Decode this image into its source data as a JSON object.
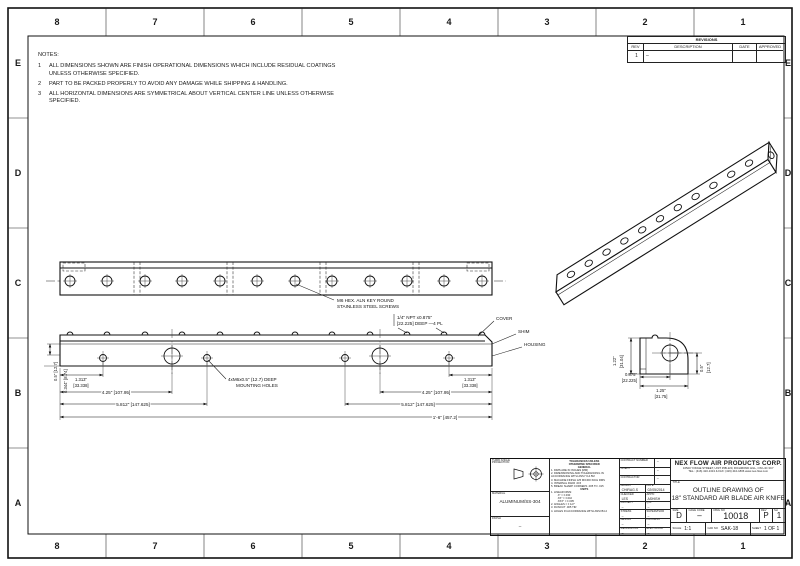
{
  "sheet": {
    "zones_h": [
      "8",
      "7",
      "6",
      "5",
      "4",
      "3",
      "2",
      "1"
    ],
    "zones_v": [
      "E",
      "D",
      "C",
      "B",
      "A"
    ]
  },
  "notes": {
    "title": "NOTES:",
    "items": [
      {
        "num": "1",
        "text": "ALL DIMENSIONS SHOWN ARE FINISH OPERATIONAL DIMENSIONS WHICH INCLUDE RESIDUAL COATINGS UNLESS OTHERWISE SPECIFIED."
      },
      {
        "num": "2",
        "text": "PART TO BE PACKED PROPERLY TO AVOID ANY DAMAGE WHILE SHIPPING & HANDLING."
      },
      {
        "num": "3",
        "text": "ALL HORIZONTAL DIMENSIONS ARE SYMMETRICAL ABOUT VERTICAL CENTER LINE UNLESS OTHERWISE SPECIFIED."
      }
    ]
  },
  "revisions": {
    "title": "REVISIONS",
    "headers": [
      "REV",
      "DESCRIPTION",
      "DATE",
      "APPROVED"
    ],
    "row": {
      "rev": "1",
      "description": "–",
      "date": "",
      "approved": ""
    }
  },
  "callouts": {
    "screws_l1": "M6 HEX. ALN KEY ROUND",
    "screws_l2": "STAINLESS STEEL SCREWS",
    "npt_l1": "1/4\" NPT x0.875\"",
    "npt_l2": "[22.225] DEEP —4 PL",
    "mount_l1": "4xM6x0.5\" (12.7) DEEP",
    "mount_l2": "MOUNTING HOLES",
    "cover": "COVER",
    "shim": "SHIM",
    "housing": "HOUSING"
  },
  "dims": {
    "front": {
      "d1_l1": "1.313\"",
      "d1_l2": "[33.338]",
      "d2": "4.25\" [107.95]",
      "d3": "5.812\" [147.625]",
      "overall": "1'-6\" [457.2]",
      "v1": "0.5\" [12.7]",
      "v2": "0.344\" [8.74]"
    },
    "side": {
      "h_l1": "1.22\"",
      "h_l2": "[31.04]",
      "b_l1": "0.875\"",
      "b_l2": "[22.225]",
      "w_l1": "1.25\"",
      "w_l2": "[31.75]",
      "r_l1": "0.5\"",
      "r_l2": "[12.7]"
    }
  },
  "titleblock": {
    "company": "NEX FLOW AIR PRODUCTS CORP.",
    "address1": "10520 YONGE STREET, UNIT 35B-220, RICHMOND HILL, ON L4C 3C7",
    "address2": "TEL.: (416) 410-1313 & FAX: (416) 410-1806  www.nex-flow.com",
    "title_label": "TITLE",
    "title_line1": "OUTLINE DRAWING OF",
    "title_line2": "18\" STANDARD AIR BLADE AIR KNIFE",
    "projection_label": "THIRD ANGLE PROJECTION",
    "material_label": "MATERIAL",
    "material_value": "ALUMINUM/SS-304",
    "finish_label": "FINISH",
    "finish_value": "–",
    "tolerances": {
      "header1": "TOLERANCES UNLESS",
      "header2": "OTHERWISE SPECIFIED",
      "general_title": "GENERAL",
      "general_items": [
        "1. DIMS ARE IN INCHES [MM]",
        "2. DIMENSIONING AND TOLERANCING IN ACCORDANCE WITH ANSI Y14.5M",
        "3. MACHINE FINISH 125 MICRO INCH RMS",
        "4. INTERNAL RADII .015",
        "5. BREAK SHARP CORNERS .005 TO .015"
      ],
      "units_title": "UNITS",
      "units_items": [
        "1. LINEAR DIMS:",
        ".X\" = ±.030",
        ".XX\" = ±.010",
        ".XXX\" = ±.005",
        "2. ANGLES = ± 1/2°",
        "3. RUNOUT .005 TIR",
        "4. HOLES IN ACCORDANCE WITH ANSI B4.2"
      ]
    },
    "fields": {
      "contract_label": "CONTRACT NUMBER",
      "contract_value": "–",
      "client_label": "CLIENT",
      "client_value": "–",
      "contractor_label": "CONTRACTOR",
      "contractor_value": "–",
      "drawn_label": "DRAWN",
      "drawn_value": "CHIRAG.S",
      "date_label": "DATE",
      "date_value": "02/05/2014",
      "checked_label": "CHECKED",
      "checked_value": "LES",
      "approved_label": "APP'D",
      "approved_value": "ASHISH",
      "project_label": "PROJECT",
      "project_value": "–",
      "qa_label": "Q.A.",
      "qa_value": "–",
      "stress_label": "STRESS",
      "stress_value": "–",
      "supervisor_label": "SUPERVISOR",
      "supervisor_value": "–",
      "design_label": "DESIGN",
      "design_value": "–",
      "process_label": "PROCESS",
      "process_value": "–",
      "mechanical_label": "MECHANICAL",
      "mechanical_value": "–",
      "electrical_label": "ELECTRICAL",
      "electrical_value": "–"
    },
    "size_label": "SIZE",
    "size_value": "D",
    "cage_label": "CAGE CODE",
    "cage_value": "–",
    "dwg_label": "DWG NO",
    "dwg_value": "10018",
    "rev_label": "REV",
    "rev_value": "P",
    "sh_label": "SH",
    "sh_value": "1",
    "scale_label": "SCALE",
    "scale_value": "1:1",
    "cad_label": "CAD NO",
    "cad_value": "SAK-18",
    "sheet_label": "SHEET",
    "sheet_value": "1 OF 1"
  }
}
